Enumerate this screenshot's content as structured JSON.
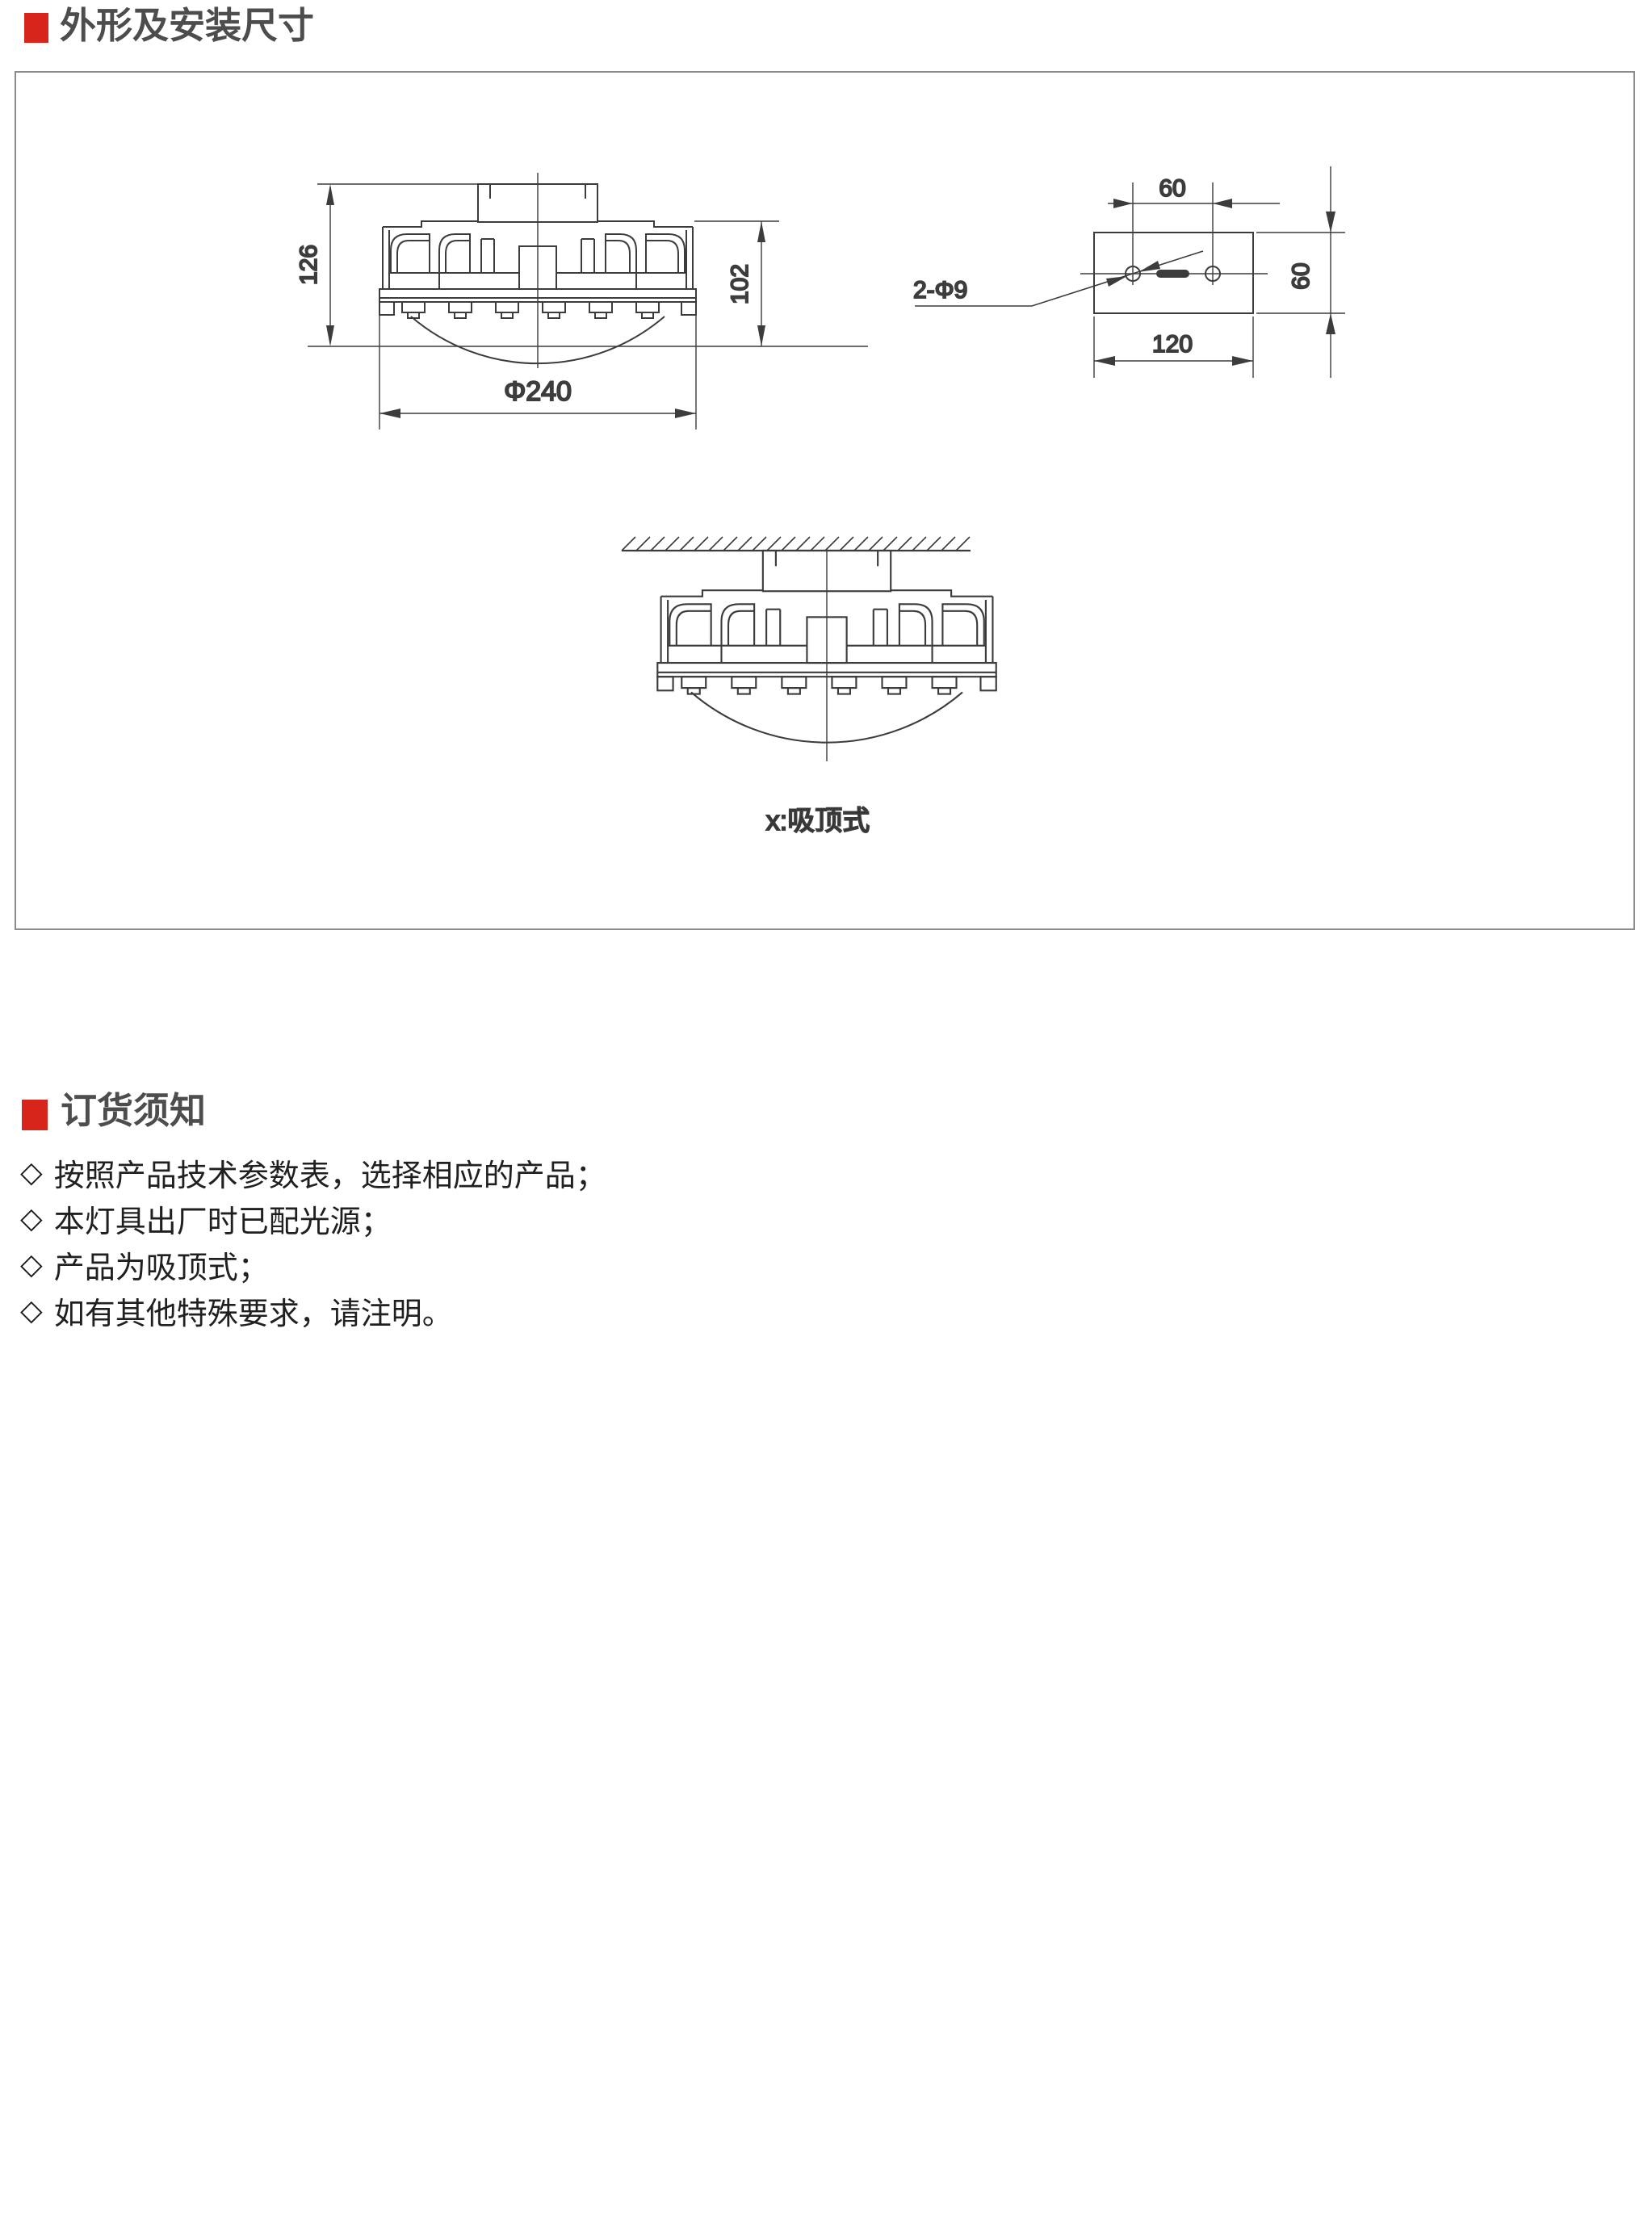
{
  "sections": {
    "dimensions": {
      "title": "外形及安装尺寸"
    },
    "ordering": {
      "title": "订货须知",
      "marker": "◇",
      "notes": [
        "按照产品技术参数表，选择相应的产品；",
        "本灯具出厂时已配光源；",
        "产品为吸顶式；",
        "如有其他特殊要求，请注明。"
      ]
    }
  },
  "drawings": {
    "front_view": {
      "height_overall": "126",
      "height_body": "102",
      "diameter": "Φ240"
    },
    "mounting_plate": {
      "hole_spacing": "60",
      "plate_height": "60",
      "plate_width": "120",
      "holes_label": "2-Φ9"
    },
    "ceiling_view": {
      "caption": "x:吸顶式"
    }
  },
  "colors": {
    "accent_red": "#d8251c",
    "heading_gray": "#4d4d4d",
    "line_gray": "#3c3c3c",
    "body_text": "#202020",
    "frame_gray": "#8b8b8b"
  }
}
